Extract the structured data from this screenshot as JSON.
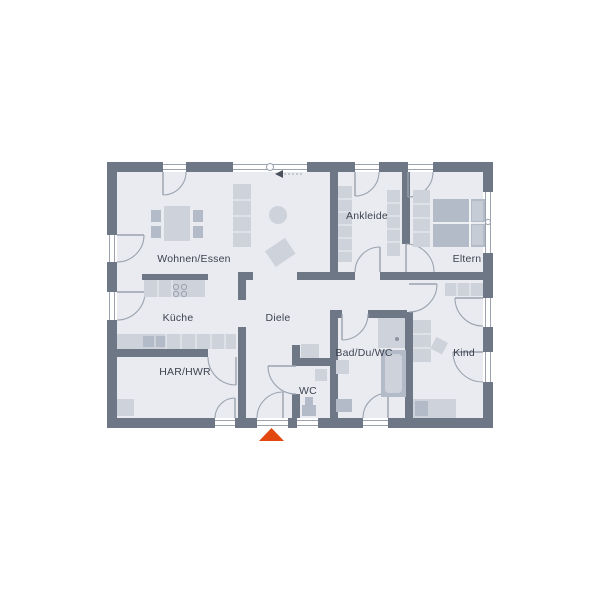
{
  "plan": {
    "type": "bungalow-floor-plan",
    "entrance_marker": "entrance-triangle",
    "sliding_door_symbol": "slide-left-arrow"
  },
  "colors": {
    "background": "#ffffff",
    "wall": "#6d7785",
    "floor": "#e9ebf0",
    "furniture": "#cdd2db",
    "furniture_dark": "#b4bbc8",
    "line": "#9aa3af",
    "label": "#3d4350",
    "accent": "#e2470f",
    "symbol": "#4a515c"
  },
  "rooms": [
    {
      "id": "wohnen-essen",
      "label": "Wohnen/Essen"
    },
    {
      "id": "kueche",
      "label": "Küche"
    },
    {
      "id": "har-hwr",
      "label": "HAR/HWR"
    },
    {
      "id": "diele",
      "label": "Diele"
    },
    {
      "id": "wc",
      "label": "WC"
    },
    {
      "id": "bad-du-wc",
      "label": "Bad/Du/WC"
    },
    {
      "id": "ankleide",
      "label": "Ankleide"
    },
    {
      "id": "eltern",
      "label": "Eltern"
    },
    {
      "id": "kind",
      "label": "Kind"
    }
  ]
}
